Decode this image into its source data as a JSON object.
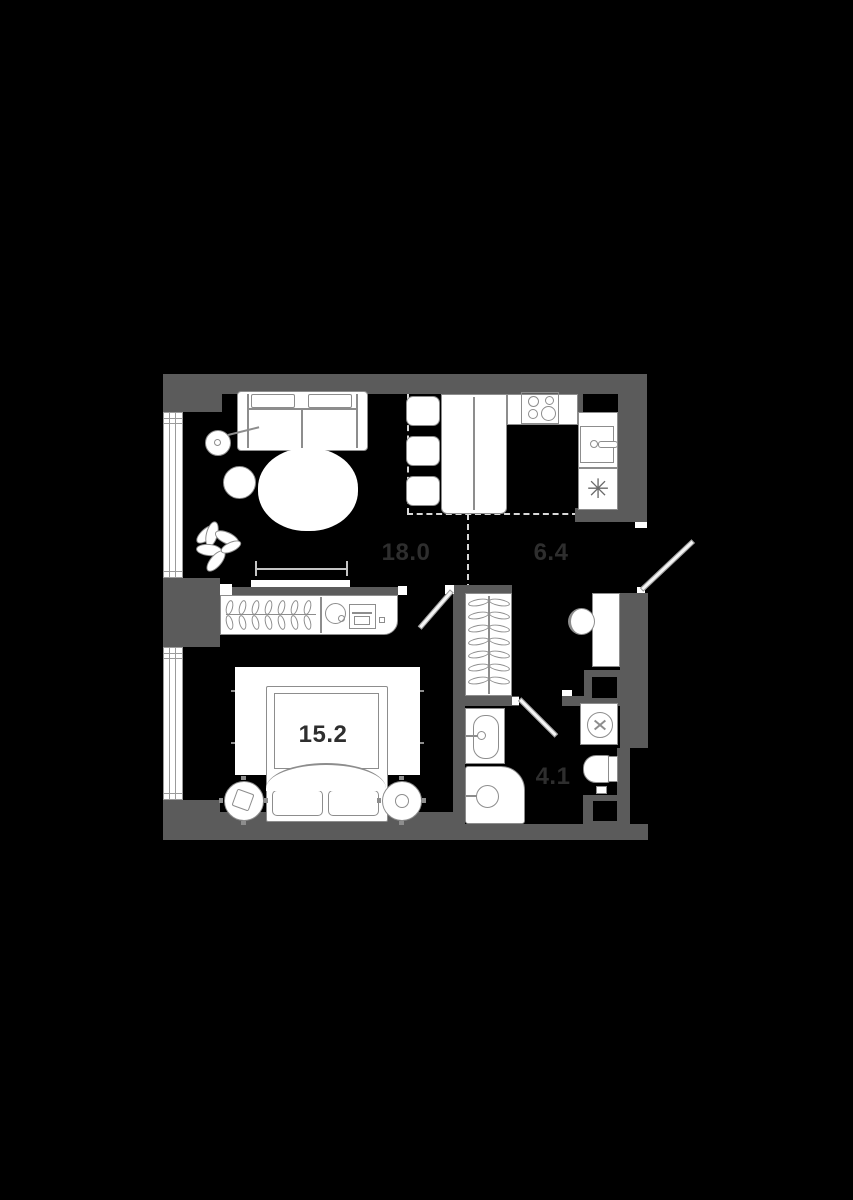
{
  "plan": {
    "type": "apartment-floor-plan",
    "rooms": {
      "living": {
        "area": "18.0"
      },
      "kitchen": {
        "area": "6.4"
      },
      "bedroom": {
        "area": "15.2"
      },
      "bathroom": {
        "area": "4.1"
      }
    },
    "icons": {
      "fridge_snowflake": "✳"
    },
    "colors": {
      "background": "#000000",
      "wall": "#5b5b5b",
      "fixture_fill": "#ffffff",
      "fixture_outline": "#8d8d8d",
      "zone_dash": "#d8d8d8",
      "label_text": "#2e2e2e"
    }
  }
}
